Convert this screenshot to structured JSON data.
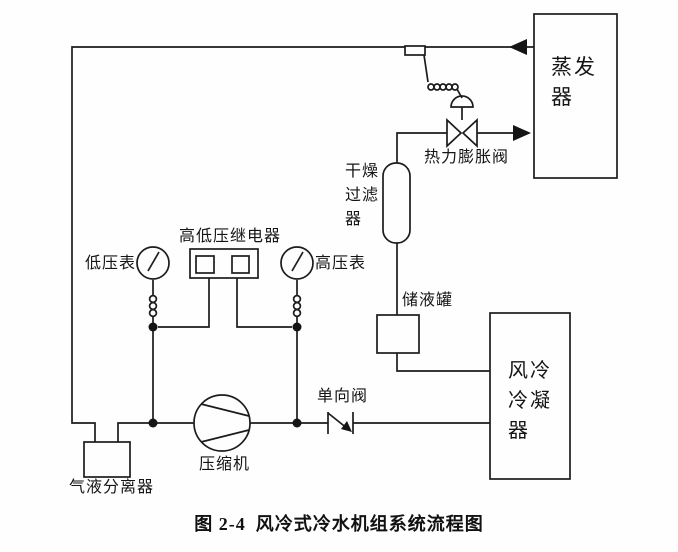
{
  "figure": {
    "caption": {
      "number": "图 2-4",
      "title": "风冷式冷水机组系统流程图"
    },
    "colors": {
      "line": "#1c1c1c",
      "arrow_fill": "#151515",
      "background": "#fefefe"
    },
    "components": {
      "evaporator": {
        "name": "蒸发器",
        "lines": [
          "蒸发",
          "器"
        ]
      },
      "condenser": {
        "name": "风冷冷凝器",
        "lines": [
          "风冷",
          "冷凝",
          "器"
        ]
      },
      "dry_filter": {
        "name": "干燥过滤器",
        "lines": [
          "干燥",
          "过滤",
          "器"
        ]
      },
      "receiver": {
        "label": "储液罐"
      },
      "expansion_valve": {
        "label": "热力膨胀阀"
      },
      "check_valve": {
        "label": "单向阀"
      },
      "compressor": {
        "label": "压缩机"
      },
      "gas_liquid_separator": {
        "label": "气液分离器"
      },
      "low_pressure_gauge": {
        "label": "低压表"
      },
      "high_pressure_gauge": {
        "label": "高压表"
      },
      "hp_lp_relay": {
        "label": "高低压继电器"
      }
    }
  }
}
